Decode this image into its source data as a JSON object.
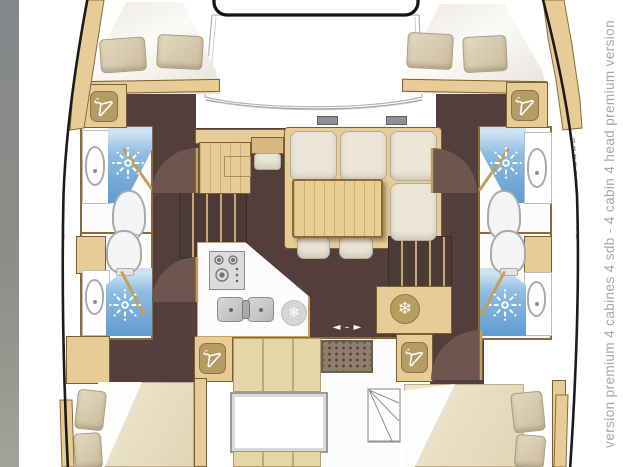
{
  "caption": {
    "text": "version premium 4 cabines 4 sdb - 4 cabin 4 head premium version"
  },
  "glyphs": {
    "snowflake": "❄",
    "arrow_left": "◄",
    "arrow_dash": "–",
    "arrow_right": "►"
  },
  "palette": {
    "hull_line": "#1b1b1b",
    "wood": "#e8cc97",
    "wood_dark": "#d9b87f",
    "wood_border": "#7c5f31",
    "floor_brown": "#523f3b",
    "door_sector": "#6f5550",
    "shower_blue": "#5f9ccf",
    "shower_blue_light": "#cde2f2",
    "cushion_cream": "#ece6d8",
    "pillow_tan": "#d8caaf",
    "bed_beige": "#e6dcc2",
    "badge_wood": "#b59c63",
    "mat_brown": "#8f7e6b",
    "steel_gray": "#c9c9c9",
    "caption_gray": "#a8a8a8",
    "photo_strip_gray": "#8b8d8b"
  },
  "icons": {
    "wardrobe": "hanger-icon",
    "refrigerator": "snowflake-icon",
    "shower": "shower-spray-icon",
    "sliding_door": "double-arrow-icon",
    "galley": [
      "stove-icon",
      "double-sink-icon"
    ]
  }
}
